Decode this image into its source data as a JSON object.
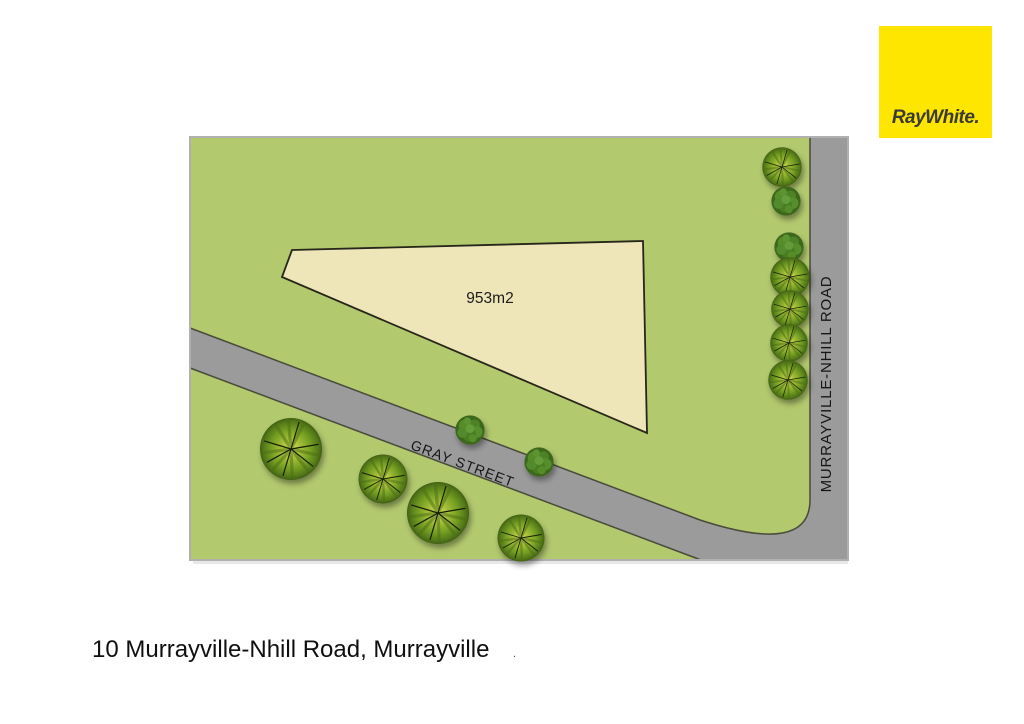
{
  "logo": {
    "text": "RayWhite.",
    "bg_color": "#FFE600",
    "text_color": "#3a3a3a"
  },
  "map": {
    "land_color": "#b2c96e",
    "road_color": "#9b9b9b",
    "border_color": "#b0b0b0",
    "lot": {
      "label": "953m2",
      "fill": "#eee5b8"
    },
    "roads": [
      {
        "name": "GRAY STREET"
      },
      {
        "name": "MURRAYVILLE-NHILL ROAD"
      }
    ],
    "trees": [
      {
        "type": "palm",
        "x": 782,
        "y": 167,
        "r": 21
      },
      {
        "type": "bush",
        "x": 786,
        "y": 201,
        "r": 17
      },
      {
        "type": "bush",
        "x": 789,
        "y": 247,
        "r": 17
      },
      {
        "type": "palm",
        "x": 790,
        "y": 277,
        "r": 21
      },
      {
        "type": "palm",
        "x": 790,
        "y": 309,
        "r": 20
      },
      {
        "type": "palm",
        "x": 789,
        "y": 343,
        "r": 20
      },
      {
        "type": "palm",
        "x": 788,
        "y": 380,
        "r": 21
      },
      {
        "type": "palm",
        "x": 291,
        "y": 449,
        "r": 33
      },
      {
        "type": "palm",
        "x": 383,
        "y": 479,
        "r": 26
      },
      {
        "type": "palm",
        "x": 438,
        "y": 513,
        "r": 33
      },
      {
        "type": "palm",
        "x": 521,
        "y": 538,
        "r": 25
      },
      {
        "type": "bush",
        "x": 470,
        "y": 430,
        "r": 17
      },
      {
        "type": "bush",
        "x": 539,
        "y": 462,
        "r": 17
      }
    ]
  },
  "caption": "10 Murrayville-Nhill Road, Murrayville",
  "stray_mark": "."
}
